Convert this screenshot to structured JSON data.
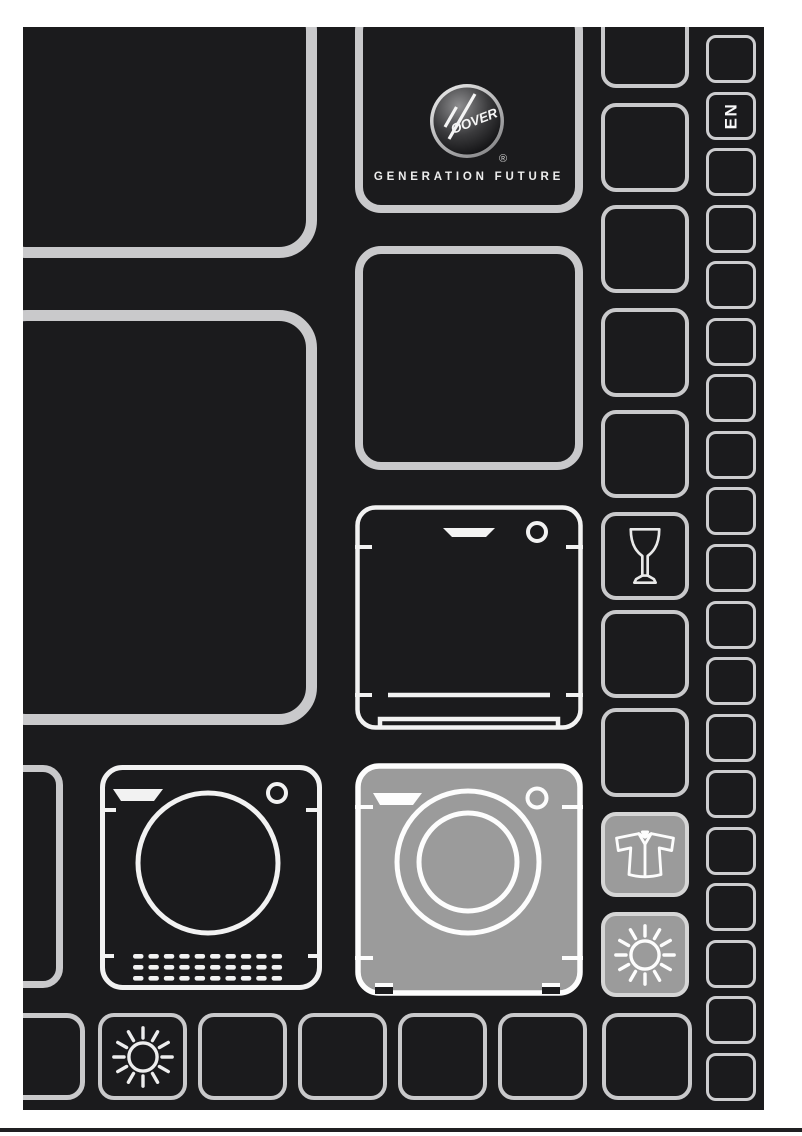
{
  "document": {
    "kind": "appliance instruction manual front cover"
  },
  "brand": {
    "logo_text": "OOVER",
    "logo_name": "HOOVER",
    "registered_mark": "®",
    "tagline": "GENERATION FUTURE"
  },
  "language_tab": {
    "label": "EN"
  },
  "icons": {
    "hoover_badge": "hoover-logo-badge",
    "wine_glass": "wine-glass-icon",
    "shirt": "shirt-icon",
    "sun_bottom_row": "sun-icon",
    "sun_right_column": "sun-icon",
    "dishwasher": "dishwasher-icon",
    "tumble_dryer": "tumble-dryer-icon",
    "washing_machine_highlighted": "washing-machine-icon"
  },
  "colors": {
    "page_bg": "#ffffff",
    "cover_bg": "#1b1b1d",
    "grid_line": "#c9c9cb",
    "drawing_line": "#f2f2f2",
    "highlight_grey": "#9b9b9b",
    "footer_rule": "#202022"
  }
}
